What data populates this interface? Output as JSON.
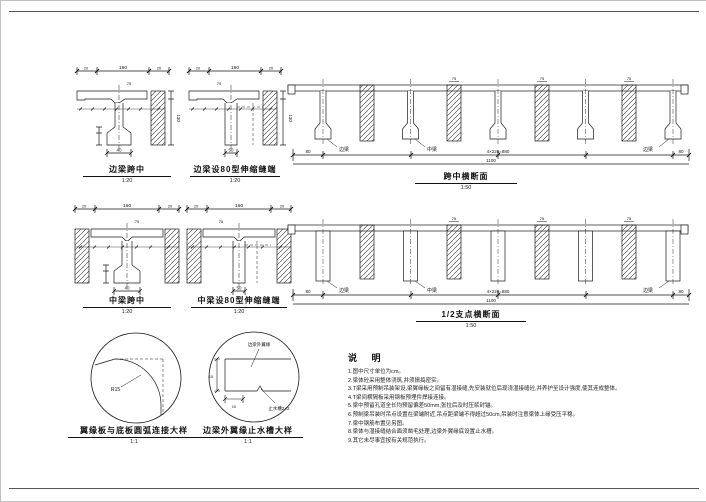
{
  "sections": {
    "a": {
      "title": "边梁跨中",
      "scale": "1:20"
    },
    "b": {
      "title": "边梁设80型伸缩缝端",
      "scale": "1:20"
    },
    "c": {
      "title": "跨中横断面",
      "scale": "1:50"
    },
    "d": {
      "title": "中梁跨中",
      "scale": "1:20"
    },
    "e": {
      "title": "中梁设80型伸缩缝端",
      "scale": "1:20"
    },
    "f": {
      "title": "1/2支点横断面",
      "scale": "1:50"
    },
    "g": {
      "title": "翼缘板与底板圆弧连接大样",
      "scale": "1:1"
    },
    "h": {
      "title": "边梁外翼缘止水槽大样",
      "scale": "1:1"
    }
  },
  "labels": {
    "edge_girder": "边梁",
    "mid_girder": "中梁",
    "outer_flange": "边梁外翼缘",
    "drip_groove": "止水槽2×2",
    "radius": "R15"
  },
  "dims": {
    "overall_small": "160",
    "seg_small": "20",
    "flange_gap": "75",
    "height": "130",
    "bulb": "40",
    "end_web": "50",
    "total": "1100",
    "center_total": "4×220=880",
    "side": "80",
    "groove_h": "15",
    "groove_w": "10"
  },
  "notes": {
    "title": "说  明",
    "items": [
      "1.图中尺寸单位为cm。",
      "2.梁体砼采用整体浇筑,并须振捣密实。",
      "3.T梁采用预制吊装架设,梁翼缘板之间留有湿接缝,先安装就位后现浇湿接缝砼,并养护至设计强度,使其连成整体。",
      "4.T梁间横隔板采用钢板预埋件焊接连接。",
      "5.梁中预留孔道全长均预留偏差50mm,张拉后及时压浆封锚。",
      "6.预制梁吊装时吊点设置在梁端附近,吊点距梁端不得超过50cm,吊装时注意梁体上缘受压平稳。",
      "7.梁中钢筋布置见另图。",
      "8.梁体与湿接缝结合面须凿毛处理,边梁外翼缘底设置止水槽。",
      "9.其它未尽事宜按有关规范执行。"
    ]
  }
}
